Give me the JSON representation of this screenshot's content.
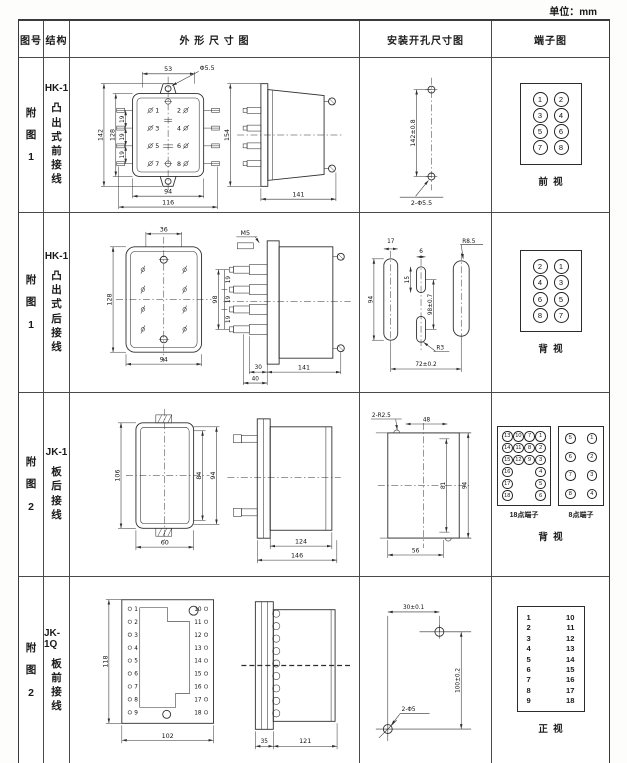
{
  "unit_note": "单位：mm",
  "header": {
    "fig": "图号",
    "structure": "结构",
    "outline": "外 形 尺 寸 图",
    "install": "安装开孔尺寸图",
    "terminal": "端子图"
  },
  "rows": [
    {
      "fig": "附\n图\n1",
      "model": "HK-1",
      "structure": "凸\n出\n式\n前\n接\n线",
      "outline": {
        "front": {
          "top": "53",
          "hole": "Φ5.5",
          "h1": "142",
          "h2": "128",
          "p1": "19",
          "p2": "19",
          "p3": "19",
          "b1": "94",
          "b2": "116",
          "t1": "1",
          "t2": "2",
          "t3": "3",
          "t4": "4",
          "t5": "5",
          "t6": "6",
          "t7": "7",
          "t8": "8"
        },
        "side": {
          "h": "154",
          "w": "141"
        }
      },
      "install": {
        "v": "142±0.8",
        "hole": "2-Φ5.5"
      },
      "terminal": {
        "n": [
          "1",
          "2",
          "3",
          "4",
          "5",
          "6",
          "7",
          "8"
        ],
        "view": "前  视"
      }
    },
    {
      "fig": "附\n图\n1",
      "model": "HK-1",
      "structure": "凸\n出\n式\n后\n接\n线",
      "outline": {
        "rear": {
          "top": "36",
          "h": "128",
          "b": "94"
        },
        "side": {
          "m": "M5",
          "h": "98",
          "p1": "19",
          "p2": "19",
          "p3": "19",
          "b1": "30",
          "b2": "40",
          "b3": "141"
        }
      },
      "install": {
        "w1": "17",
        "h1": "94",
        "w2": "6",
        "h2": "15",
        "r1": "R8.5",
        "v": "98±0.7",
        "r2": "R3",
        "b": "72±0.2"
      },
      "terminal": {
        "n": [
          "2",
          "1",
          "4",
          "3",
          "6",
          "5",
          "8",
          "7"
        ],
        "view": "背  视"
      }
    },
    {
      "fig": "附\n图\n2",
      "model": "JK-1",
      "structure": "板\n后\n接\n线",
      "outline": {
        "front": {
          "h": "106",
          "i1": "84",
          "i2": "94",
          "b": "60"
        },
        "side": {
          "w1": "124",
          "w2": "146"
        }
      },
      "install": {
        "r": "2-R2.5",
        "top": "48",
        "i": "81",
        "o": "94",
        "b": "56"
      },
      "terminal": {
        "b18": {
          "label": "18点端子",
          "rows": [
            [
              "13",
              "10",
              "7",
              "1"
            ],
            [
              "14",
              "11",
              "8",
              "2"
            ],
            [
              "15",
              "12",
              "9",
              "3"
            ],
            [
              "16",
              null,
              null,
              "4"
            ],
            [
              "17",
              null,
              null,
              "5"
            ],
            [
              "18",
              null,
              null,
              "6"
            ]
          ]
        },
        "b8": {
          "label": "8点端子",
          "rows": [
            [
              "5",
              "1"
            ],
            [
              "6",
              "2"
            ],
            [
              "7",
              "3"
            ],
            [
              "8",
              "4"
            ]
          ]
        },
        "view": "背  视"
      }
    },
    {
      "fig": "附\n图\n2",
      "model": "JK-1Q",
      "structure": "板\n前\n接\n线",
      "outline": {
        "front": {
          "h": "118",
          "b": "102",
          "lt": [
            "1",
            "2",
            "3",
            "4",
            "5",
            "6",
            "7",
            "8",
            "9"
          ],
          "rt": [
            "10",
            "11",
            "12",
            "13",
            "14",
            "15",
            "16",
            "17",
            "18"
          ]
        },
        "side": {
          "w1": "35",
          "w2": "121"
        }
      },
      "install": {
        "top": "30±0.1",
        "v": "100±0.2",
        "hole": "2-Φ5"
      },
      "terminal": {
        "left": [
          "1",
          "2",
          "3",
          "4",
          "5",
          "6",
          "7",
          "8",
          "9"
        ],
        "right": [
          "10",
          "11",
          "12",
          "13",
          "14",
          "15",
          "16",
          "17",
          "18"
        ],
        "view": "正  视"
      }
    }
  ]
}
